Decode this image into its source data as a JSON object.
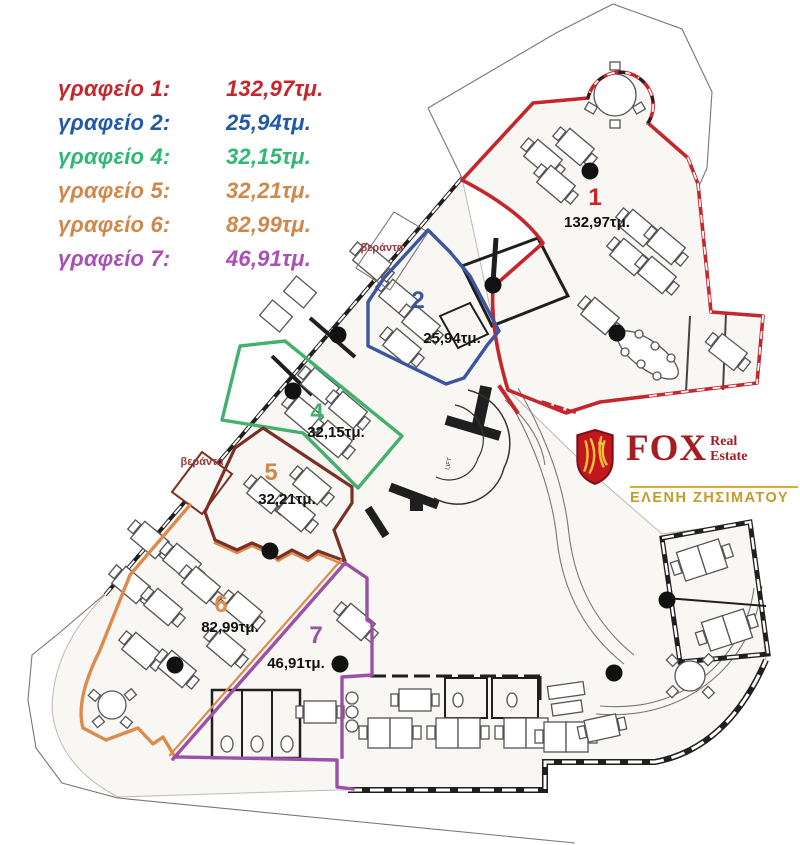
{
  "legend": {
    "items": [
      {
        "label": "γραφείο 1:",
        "value": "132,97τμ.",
        "color": "#c5262c"
      },
      {
        "label": "γραφείο 2:",
        "value": "25,94τμ.",
        "color": "#1e5aa7"
      },
      {
        "label": "γραφείο 4:",
        "value": "32,15τμ.",
        "color": "#2eb873"
      },
      {
        "label": "γραφείο 5:",
        "value": "32,21τμ.",
        "color": "#d2874a"
      },
      {
        "label": "γραφείο 6:",
        "value": "82,99τμ.",
        "color": "#d2874a"
      },
      {
        "label": "γραφείο 7:",
        "value": "46,91τμ.",
        "color": "#aa4fb5"
      }
    ]
  },
  "logo": {
    "brand": "FOX",
    "real": "Real",
    "estate": "Estate",
    "agent": "ΕΛΕΝΗ ΖΗΣΙΜΑΤΟΥ",
    "shield_red": "#c4161d",
    "gold": "#d4af37",
    "text_red": "#a51d22",
    "agent_gold": "#c29b2a"
  },
  "plan": {
    "offices": [
      {
        "id": "office-1",
        "number": "1",
        "area": "132,97τμ.",
        "color": "#c5262c",
        "number_color": "#c5262c"
      },
      {
        "id": "office-2",
        "number": "2",
        "area": "25,94τμ.",
        "color": "#3b55a0",
        "number_color": "#3b55a0"
      },
      {
        "id": "office-4",
        "number": "4",
        "area": "32,15τμ.",
        "color": "#44b06e",
        "number_color": "#44b06e"
      },
      {
        "id": "office-5",
        "number": "5",
        "area": "32,21τμ.",
        "color": "#7c2f25",
        "number_color": "#d2874a"
      },
      {
        "id": "office-6",
        "number": "6",
        "area": "82,99τμ.",
        "color": "#dd8a4d",
        "number_color": "#dd8a4d"
      },
      {
        "id": "office-7",
        "number": "7",
        "area": "46,91τμ.",
        "color": "#9b51a5",
        "number_color": "#9b51a5"
      }
    ],
    "veranda_label": "βεράντα",
    "veranda_color": "#963a40",
    "lift_label": "LIFT"
  }
}
